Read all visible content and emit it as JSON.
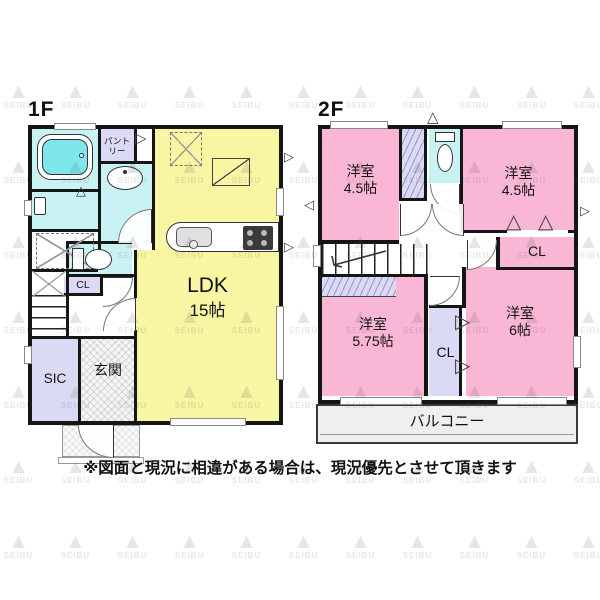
{
  "watermark": {
    "brand": "SEIBU",
    "logo_icon": "mountain-logo-icon"
  },
  "icons": {
    "door_swing_right": "▷",
    "door_swing_left": "◁",
    "door_fold_up": "△",
    "gable_vent": "△",
    "logo_mark": "▲"
  },
  "floor1": {
    "name": "1F",
    "ldk": {
      "label": "LDK",
      "size": "15帖"
    },
    "pantry": {
      "label": "パントリー"
    },
    "closet": {
      "label": "CL"
    },
    "shoe_closet": {
      "label": "SIC"
    },
    "entrance": {
      "label": "玄関"
    }
  },
  "floor2": {
    "name": "2F",
    "room_nw": {
      "label": "洋室",
      "size": "4.5帖"
    },
    "room_ne": {
      "label": "洋室",
      "size": "4.5帖"
    },
    "closet_ne": {
      "label": "CL"
    },
    "room_sw": {
      "label": "洋室",
      "size": "5.75帖"
    },
    "closet_mid": {
      "label": "CL"
    },
    "room_se": {
      "label": "洋室",
      "size": "6帖"
    },
    "balcony": {
      "label": "バルコニー"
    }
  },
  "disclaimer": "※図面と現況に相違がある場合は、現況優先とさせて頂きます",
  "colors": {
    "ldk_yellow": "#f8f5a3",
    "room_pink": "#f9b6d5",
    "wet_area_cyan": "#c9f2f4",
    "closet_lavender": "#dadaf5",
    "bath_water": "#7de7ec",
    "wall": "#151515"
  }
}
